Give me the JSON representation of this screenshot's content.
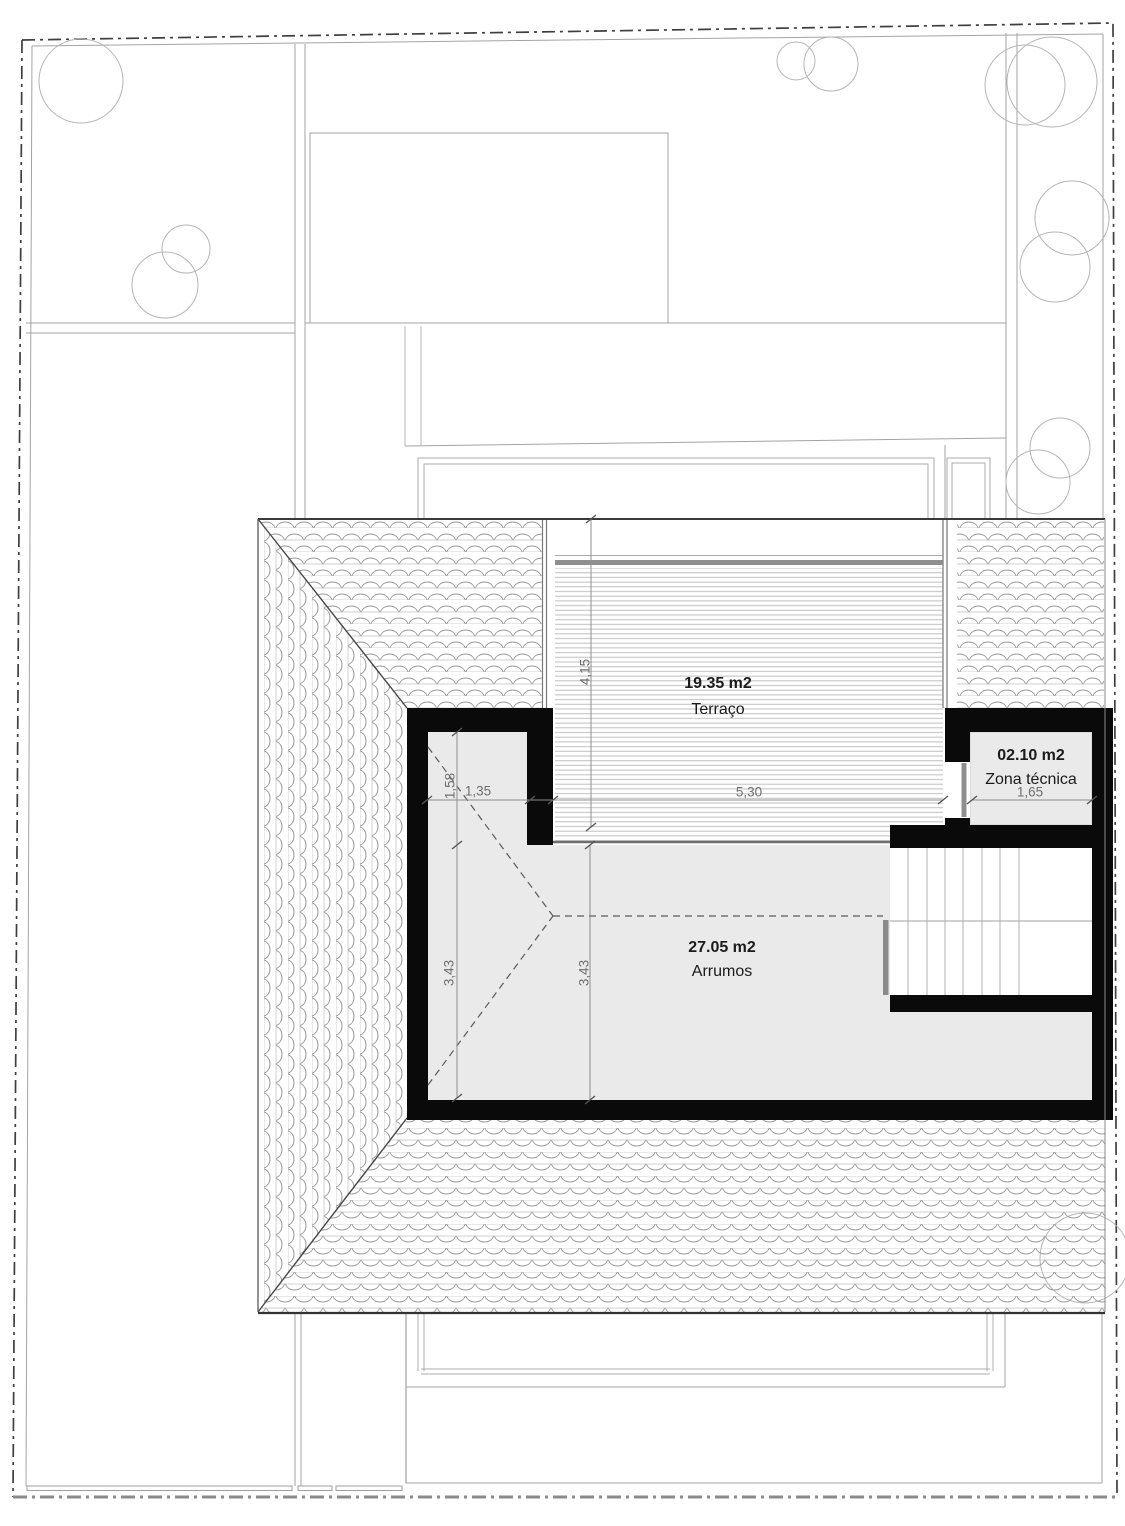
{
  "plan": {
    "type": "architectural-roof-plan",
    "rooms": [
      {
        "area": "19.35 m2",
        "name": "Terraço"
      },
      {
        "area": "27.05 m2",
        "name": "Arrumos"
      },
      {
        "area": "02.10 m2",
        "name": "Zona técnica"
      }
    ],
    "dimensions": [
      {
        "id": "terrace-depth",
        "value": "4,15"
      },
      {
        "id": "terrace-width",
        "value": "5,30"
      },
      {
        "id": "nook-width",
        "value": "1,35"
      },
      {
        "id": "nook-depth",
        "value": "1,58"
      },
      {
        "id": "room-depth-left",
        "value": "3,43"
      },
      {
        "id": "room-depth-mid",
        "value": "3,43"
      },
      {
        "id": "zona-width",
        "value": "1,65"
      }
    ],
    "colors": {
      "wall": "#0a0a0a",
      "room_fill": "#eaeaea",
      "dimension_text": "#6f6f6f",
      "line": "#9a9a9a"
    }
  }
}
